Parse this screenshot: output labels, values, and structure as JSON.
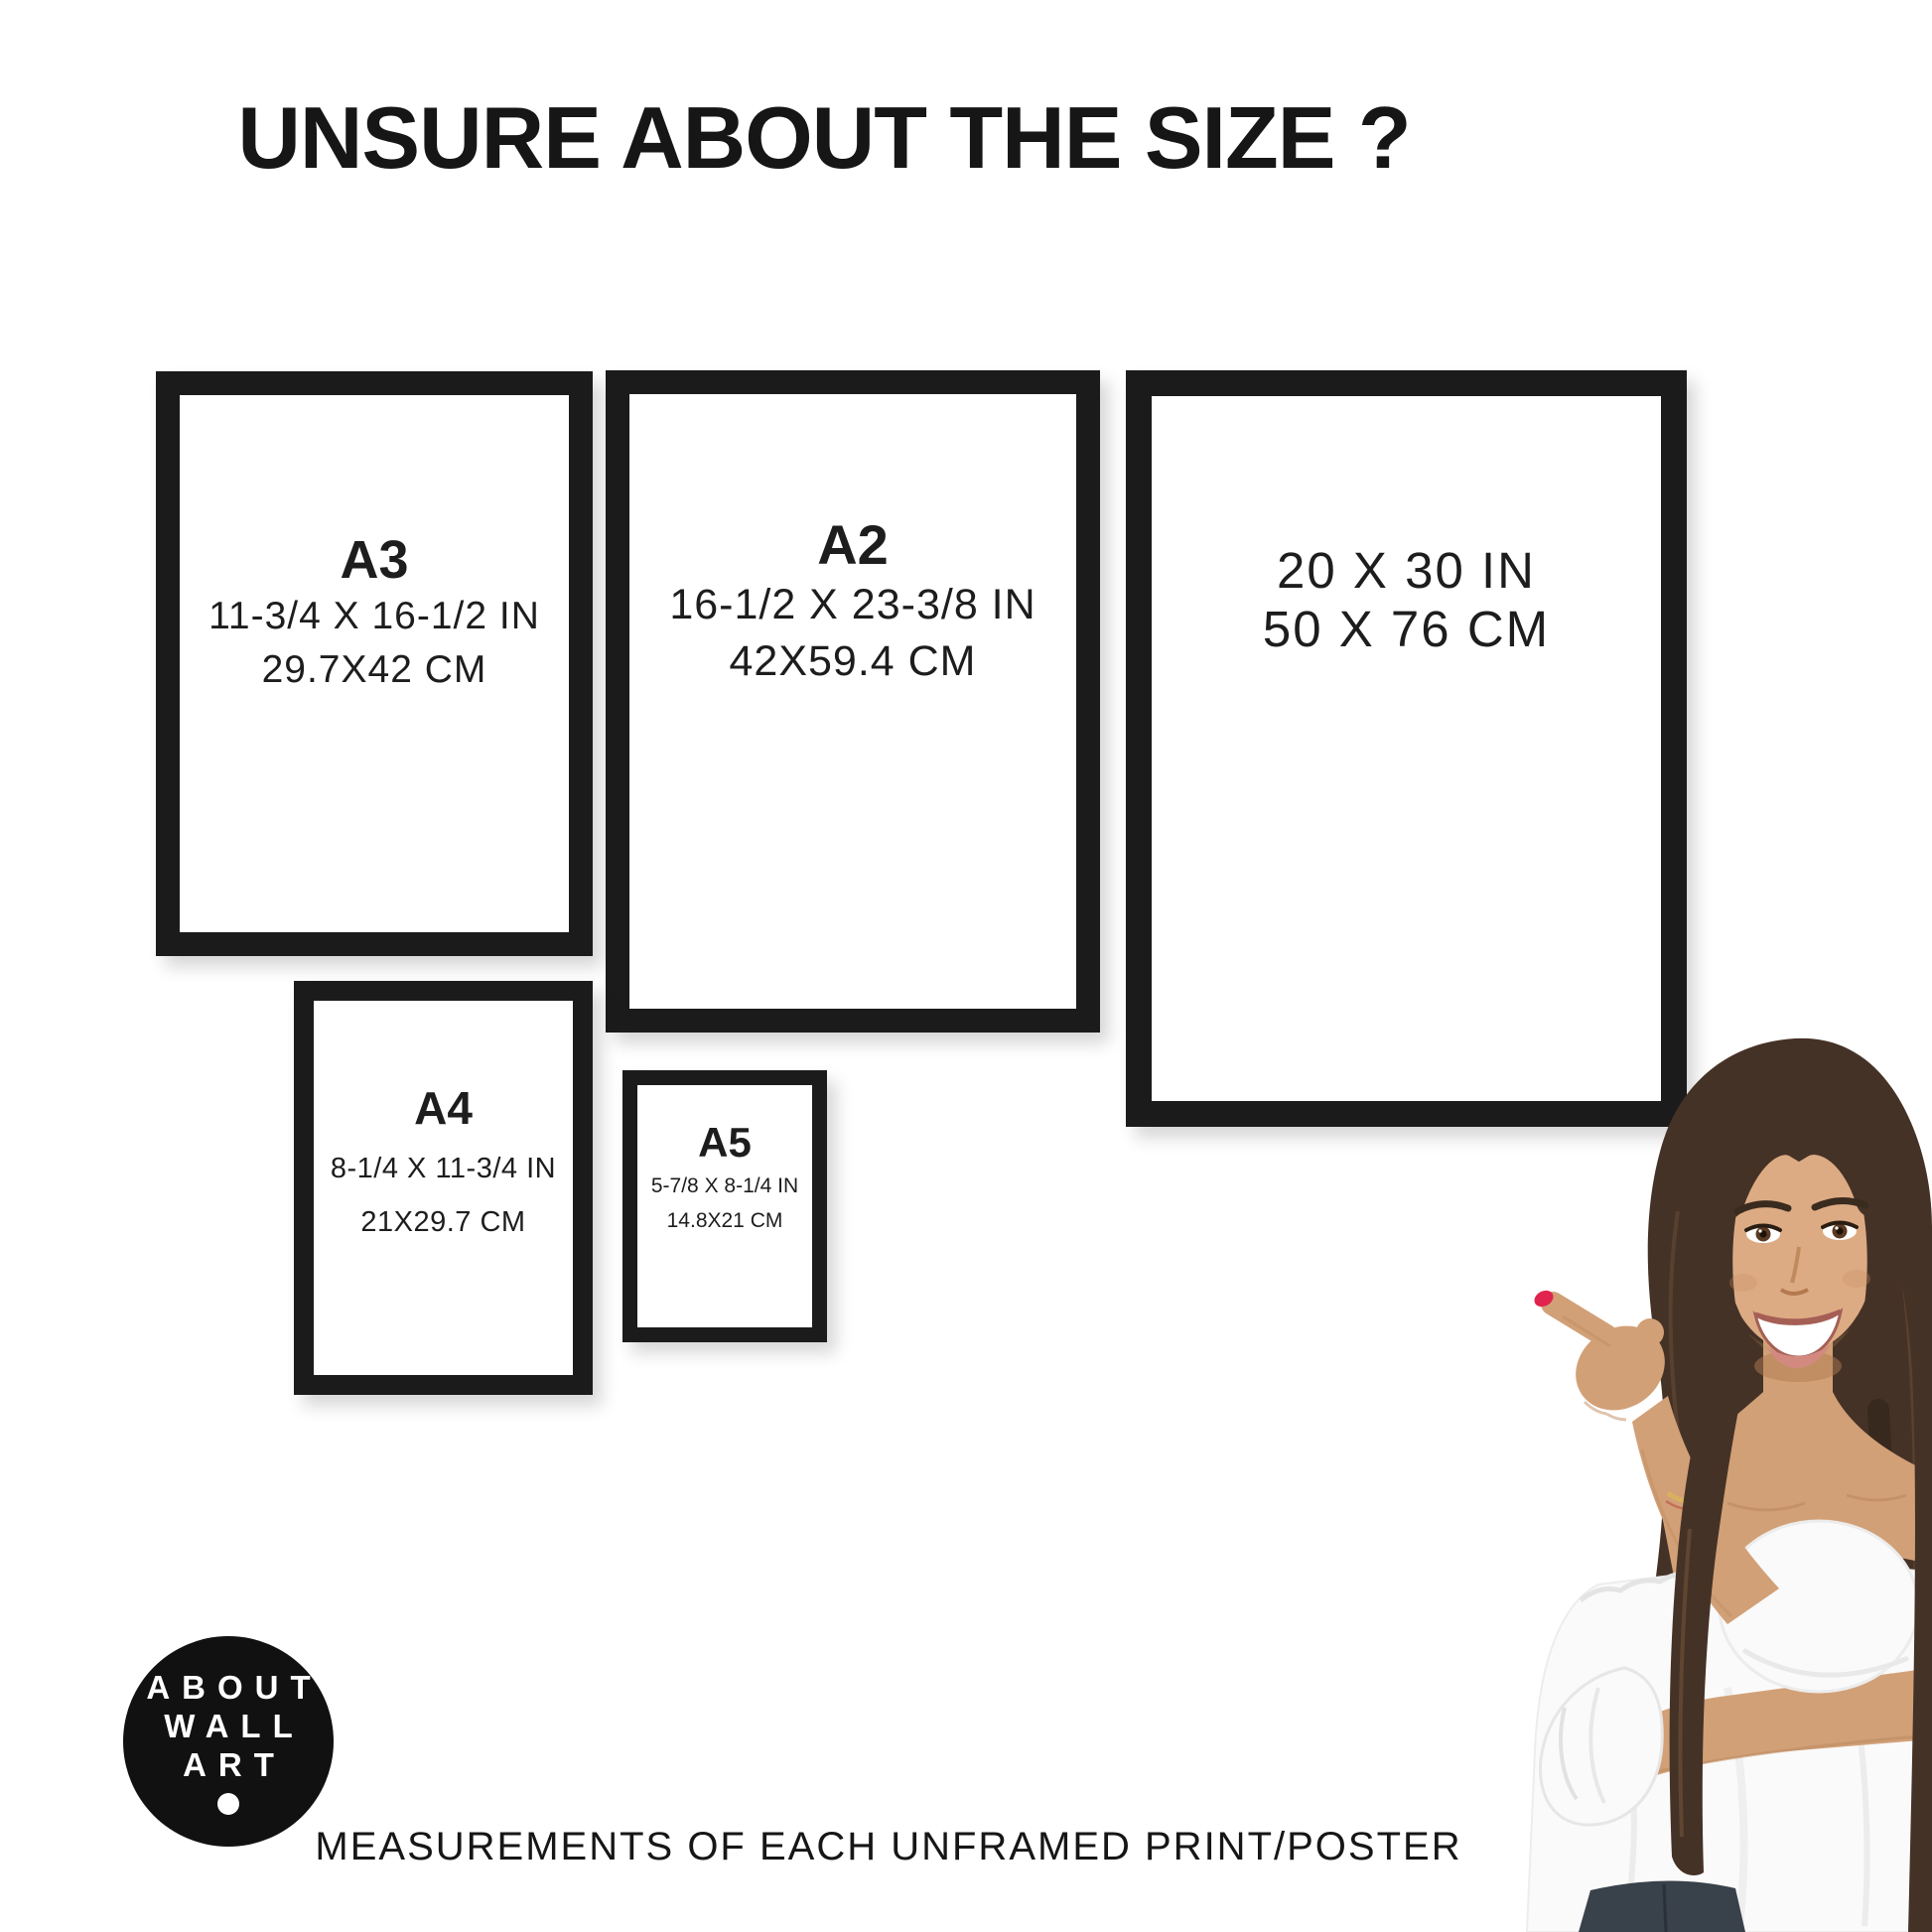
{
  "title": "UNSURE ABOUT THE SIZE ?",
  "frames": [
    {
      "id": "a3",
      "label": "A3",
      "inches": "11-3/4 X 16-1/2 IN",
      "cm": "29.7X42 CM"
    },
    {
      "id": "a2",
      "label": "A2",
      "inches": "16-1/2 X 23-3/8 IN",
      "cm": "42X59.4 CM"
    },
    {
      "id": "20x30",
      "label": "",
      "inches": "20 X 30 IN",
      "cm": "50 X 76 CM"
    },
    {
      "id": "a4",
      "label": "A4",
      "inches": "8-1/4 X 11-3/4 IN",
      "cm": "21X29.7 CM"
    },
    {
      "id": "a5",
      "label": "A5",
      "inches": "5-7/8 X 8-1/4 IN",
      "cm": "14.8X21 CM"
    }
  ],
  "logo": {
    "lines": [
      "ABOUT",
      "WALL",
      "ART"
    ]
  },
  "caption": "MEASUREMENTS OF EACH UNFRAMED PRINT/POSTER",
  "colors": {
    "frame": "#1b1b1b",
    "text": "#161616",
    "logo_bg": "#111111",
    "logo_text": "#ffffff",
    "nail": "#e0244d",
    "hair": "#453226",
    "skin": "#d2a077",
    "blouse": "#fafafa",
    "jeans": "#39414b"
  }
}
